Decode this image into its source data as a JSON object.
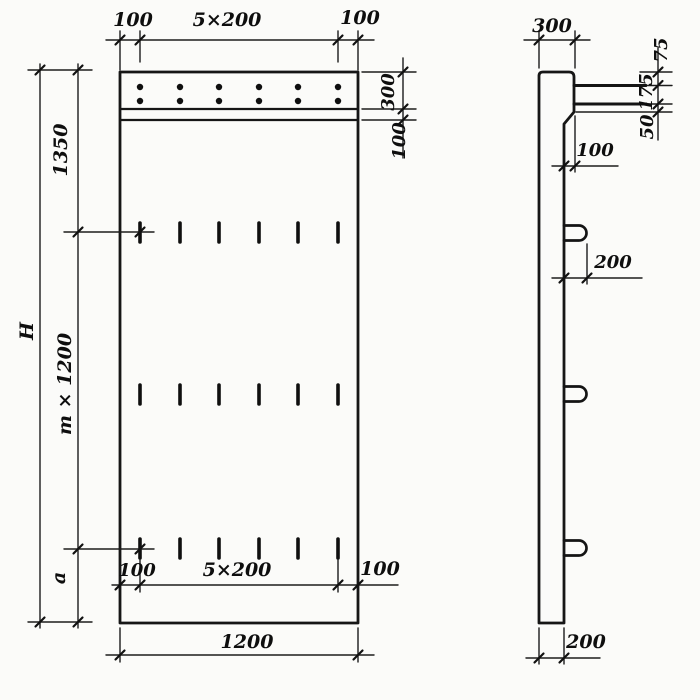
{
  "front_view": {
    "top_dimension": {
      "left": "100",
      "middle": "5×200",
      "right": "100"
    },
    "right_dimension": {
      "band_height": "300",
      "ledge_height": "100"
    },
    "left_dimension": {
      "overall_height": "H",
      "upper": "1350",
      "middle": "m × 1200",
      "lower": "a"
    },
    "bottom_inner_dimension": {
      "left": "100",
      "middle": "5×200",
      "right": "100"
    },
    "bottom_dimension": {
      "width": "1200"
    }
  },
  "side_view": {
    "top_dimension": {
      "thickness": "300"
    },
    "right_stack": {
      "top": "75",
      "middle": "175",
      "bottom": "50"
    },
    "step_dimension": "100",
    "loop_dimension": "200",
    "bottom_dimension": {
      "thickness": "200"
    }
  },
  "ink_color": "#141414",
  "paper_color": "#fbfbf9"
}
